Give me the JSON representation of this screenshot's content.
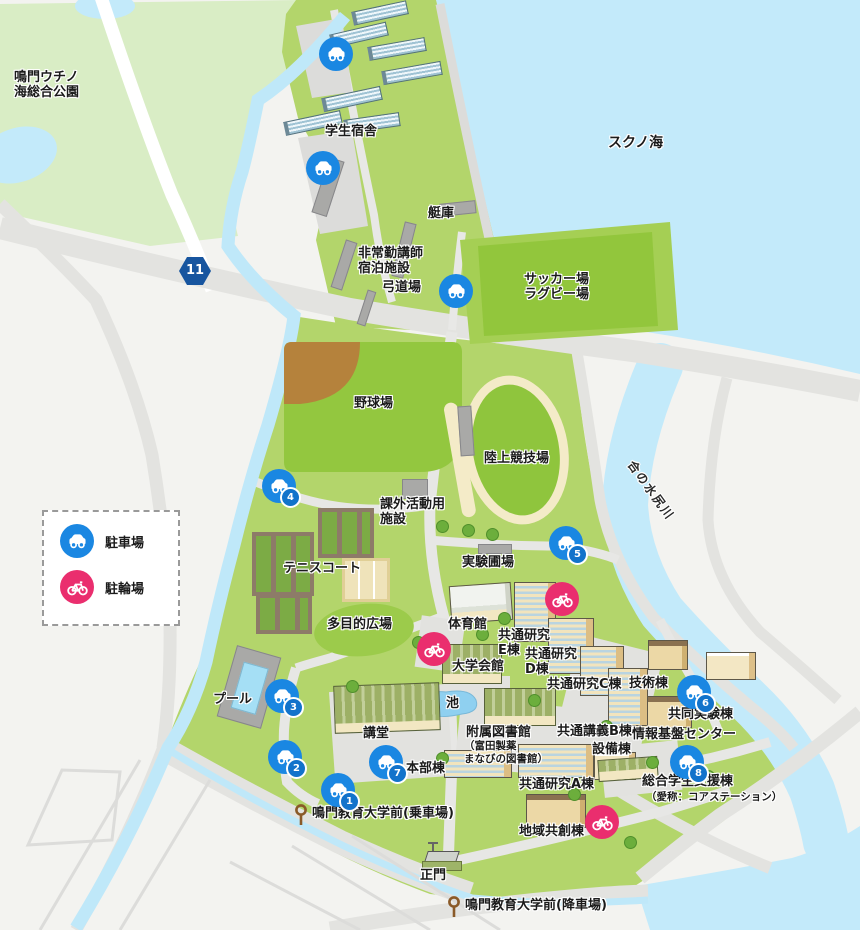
{
  "areas": {
    "park": "鳴門ウチノ\n海総合公園",
    "sea": "スクノ海",
    "river": "合の水尻川"
  },
  "facilities": {
    "dorm": "学生宿舎",
    "boathouse": "艇庫",
    "lecturer_lodging": "非常勤講師\n宿泊施設",
    "archery": "弓道場",
    "soccer_rugby": "サッカー場\nラグビー場",
    "baseball": "野球場",
    "track": "陸上競技場",
    "extracurricular": "課外活動用\n施設",
    "experimental_field": "実験圃場",
    "tennis": "テニスコート",
    "multipurpose": "多目的広場",
    "gym": "体育館",
    "research_e": "共通研究\nE棟",
    "univ_hall": "大学会館",
    "research_d": "共通研究\nD棟",
    "research_c": "共通研究C棟",
    "tech": "技術棟",
    "pool": "プール",
    "pond": "池",
    "auditorium": "講堂",
    "library_main": "附属図書館",
    "library_sub": "（富田製薬\nまなびの図書館）",
    "lecture_b": "共通講義B棟",
    "equipment": "設備棟",
    "joint_lab": "共同実験棟",
    "info_center": "情報基盤センター",
    "research_a": "共通研究A棟",
    "headquarters": "本部棟",
    "support_main": "総合学生支援棟",
    "support_sub": "（愛称：コアステーション）",
    "regional": "地域共創棟",
    "main_gate": "正門"
  },
  "bus_stops": {
    "boarding": "鳴門教育大学前(乗車場)",
    "alighting": "鳴門教育大学前(降車場)"
  },
  "legend": {
    "parking_label": "駐車場",
    "bicycle_label": "駐輪場"
  },
  "route_badge": {
    "number": "11"
  },
  "parking_markers": {
    "numbers": [
      "1",
      "2",
      "3",
      "4",
      "5",
      "6",
      "7",
      "8"
    ]
  },
  "colors": {
    "water": "#c3eafa",
    "campus_green": "#b3d56b",
    "field_green": "#93c73f",
    "park_green": "#d9edc5",
    "road_gray": "#e3e3e0",
    "parking_blue": "#1a87e2",
    "bicycle_pink": "#ea2e6e",
    "route_blue": "#17559f",
    "bus_stop_brown": "#8a5a28",
    "infield_brown": "#b5823c",
    "track_cream": "#f4ebc8"
  }
}
